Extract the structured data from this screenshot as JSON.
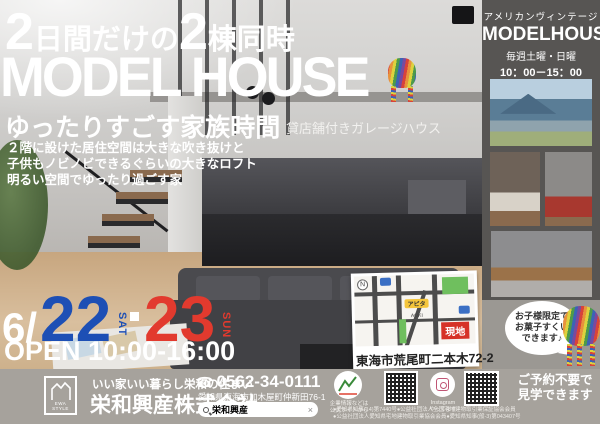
{
  "colors": {
    "accent_blue": "#1d4fb5",
    "accent_red": "#e23a2e",
    "site_badge_red": "#d63227",
    "sidebar_bg": "#575553",
    "footer_bg": "#a6a29c"
  },
  "hero": {
    "headline_num1": "2",
    "headline_text1": "日間だけの",
    "headline_num2": "2",
    "headline_text2": "棟同時",
    "title": "MODEL HOUSE",
    "subtitle": "ゆったりすごす家族時間",
    "tag": "貸店舗付きガレージハウス",
    "description_lines": [
      "２階に設けた居住空間は大きな吹き抜けと",
      "子供もノビノビできるぐらいの大きなロフト",
      "明るい空間でゆったり過ごす家"
    ]
  },
  "event": {
    "month_prefix": "6/",
    "day1": "22",
    "day1_suffix": "SAT",
    "day2": "23",
    "day2_suffix": "SUN",
    "open_hours": "OPEN 10:00-16:00"
  },
  "sidebar": {
    "category": "アメリカンヴィンテージ",
    "title": "MODELHOUSE",
    "schedule": "毎週土曜・日曜",
    "hours": "10：00－15：00",
    "note_line1": "となりにあるこちらの",
    "note_line2": "モデルハウスも見学できます♪"
  },
  "bubble": {
    "line1": "お子様限定で",
    "line2": "お菓子すくい",
    "line3": "できます♪"
  },
  "map": {
    "compass": "N",
    "store1": "アピタ",
    "store2": "AOKI",
    "site_badge": "現地",
    "address": "東海市荒尾町二本木72-2"
  },
  "footer": {
    "logo_label": "EWA STYLE",
    "tagline": "いい家いい暮らし栄和の住まい",
    "company": "栄和興産株式会社",
    "phone_icon": "☎",
    "phone": "0562-34-0111",
    "address": "愛知県東海市加木屋町仲新田76-1",
    "search_value": "栄和興産",
    "search_close": "×",
    "site_note_line1": "企業情報などは",
    "site_note_line2": "公式サイトから",
    "instagram_note_line1": "Instagram",
    "instagram_note_line2": "やってます",
    "reservation_line1": "ご予約不要で",
    "reservation_line2": "見学できます",
    "license_line1": "●愛知県知事(14)第7440号●公益社団法人全国宅地建物取引業保証協会会員",
    "license_line2": "●公益社団法人愛知県宅地建物取引業協会会員●愛知県知事(般-3)第043407号"
  }
}
